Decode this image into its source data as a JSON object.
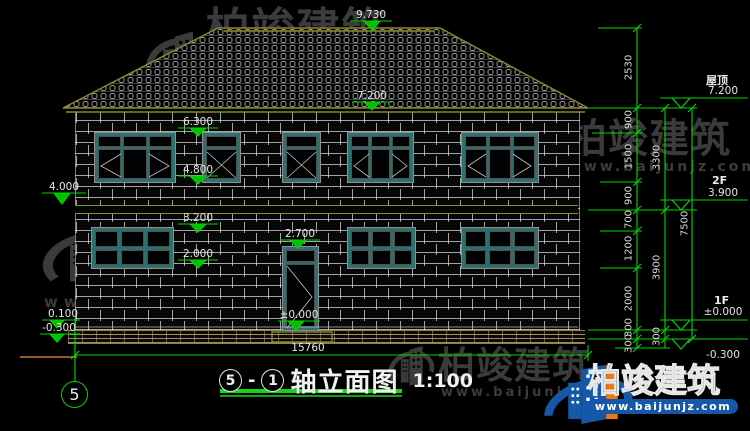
{
  "watermark": {
    "brand": "柏竣建筑",
    "site": "www.baijunjz.com"
  },
  "title": {
    "axis_from": "5",
    "sep": "-",
    "axis_to": "1",
    "text": "轴立面图",
    "scale": "1:100"
  },
  "axis": {
    "bubble": "5"
  },
  "levels": {
    "ridge": "9.730",
    "eave": "7.200",
    "win2_head": "6.300",
    "win2_sill": "4.800",
    "band_left": "4.000",
    "win1_head": "3.200",
    "door_head": "2.700",
    "win1_sill": "2.000",
    "floor_door": "±0.000",
    "plinth_left": "0.100",
    "grade_left": "-0.300",
    "right_roof_label": "屋顶",
    "right_roof": "7.200",
    "right_f2_label": "2F",
    "right_f2": "3.900",
    "right_f1_label": "1F",
    "right_f1": "±0.000",
    "right_grade": "-0.300"
  },
  "dims": {
    "width_total": "15760",
    "inner": [
      "2530",
      "900",
      "1500",
      "900",
      "700",
      "1200",
      "2000",
      "300",
      "300"
    ],
    "mid": [
      "3300",
      "3900",
      "300"
    ],
    "outer": [
      "7500"
    ]
  },
  "colors": {
    "line_green": "#00d800",
    "line_olive": "#8a8a2e",
    "frame_teal": "#2e6f6f",
    "ground_orange": "#c87a28",
    "brand_blue": "#1558a8",
    "brand_orange": "#e87818"
  }
}
